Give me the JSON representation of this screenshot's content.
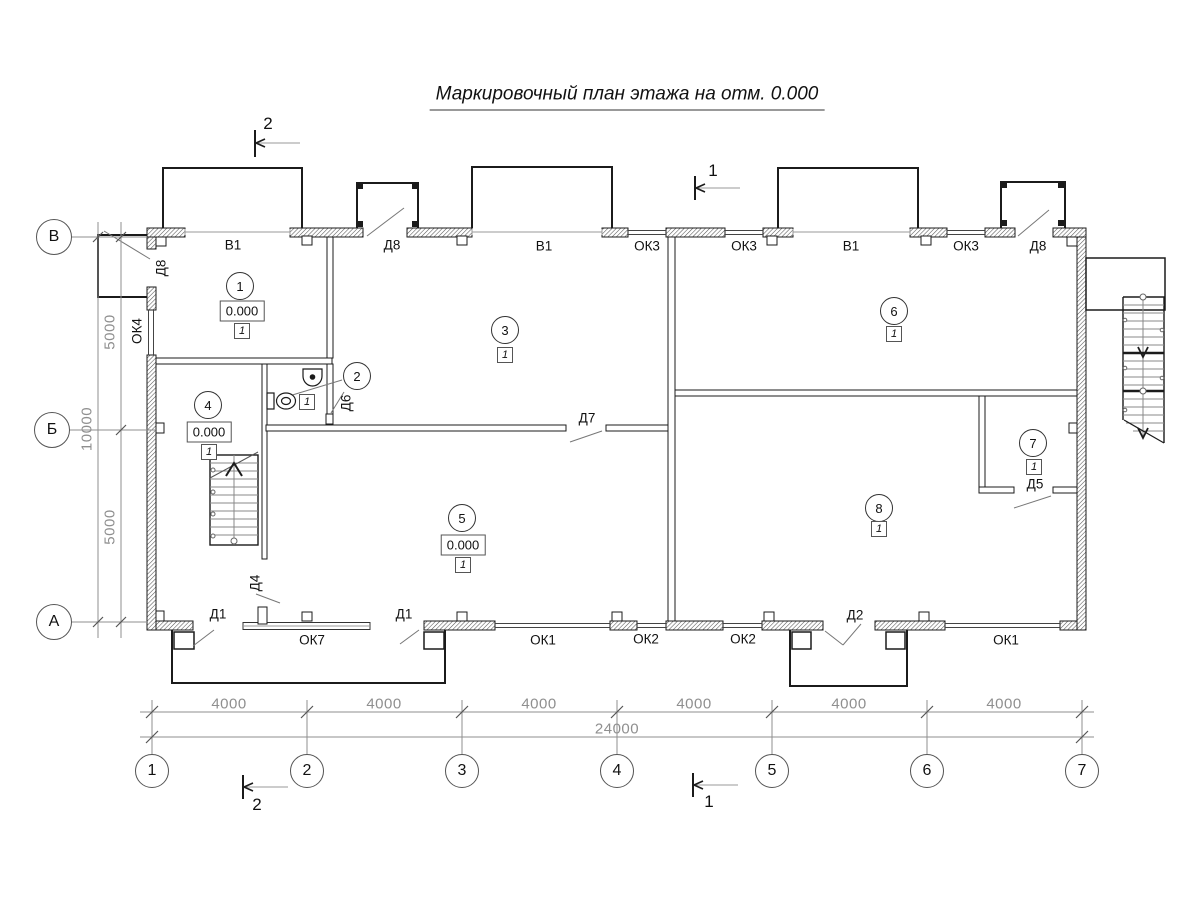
{
  "title": "Маркировочный план этажа на отм. 0.000",
  "axes": {
    "bottom": [
      "1",
      "2",
      "3",
      "4",
      "5",
      "6",
      "7"
    ],
    "left": [
      "В",
      "Б",
      "А"
    ]
  },
  "dims": {
    "segments": [
      "4000",
      "4000",
      "4000",
      "4000",
      "4000",
      "4000"
    ],
    "total": "24000",
    "left": [
      "5000",
      "10000",
      "5000"
    ]
  },
  "sections": {
    "top_left": "2",
    "top_right": "1",
    "bottom_left": "2",
    "bottom_right": "1"
  },
  "rooms": [
    {
      "num": "1",
      "elev": "0.000",
      "fin": "1"
    },
    {
      "num": "2",
      "fin": "1"
    },
    {
      "num": "3",
      "fin": "1"
    },
    {
      "num": "4",
      "elev": "0.000",
      "fin": "1"
    },
    {
      "num": "5",
      "elev": "0.000",
      "fin": "1"
    },
    {
      "num": "6",
      "fin": "1"
    },
    {
      "num": "7",
      "fin": "1"
    },
    {
      "num": "8",
      "fin": "1"
    }
  ],
  "marks": {
    "top": [
      "В1",
      "Д8",
      "В1",
      "ОК3",
      "ОК3",
      "В1",
      "ОК3",
      "Д8"
    ],
    "left_wall": [
      "Д8",
      "ОК4"
    ],
    "bottom": [
      "Д1",
      "ОК7",
      "Д1",
      "ОК1",
      "ОК2",
      "ОК2",
      "Д2",
      "ОК1"
    ],
    "interior": [
      "Д6",
      "Д7",
      "Д4",
      "Д5"
    ]
  },
  "colors": {
    "line": "#1b1b1b",
    "dim": "#8f8f8f",
    "accent": "#444444"
  }
}
